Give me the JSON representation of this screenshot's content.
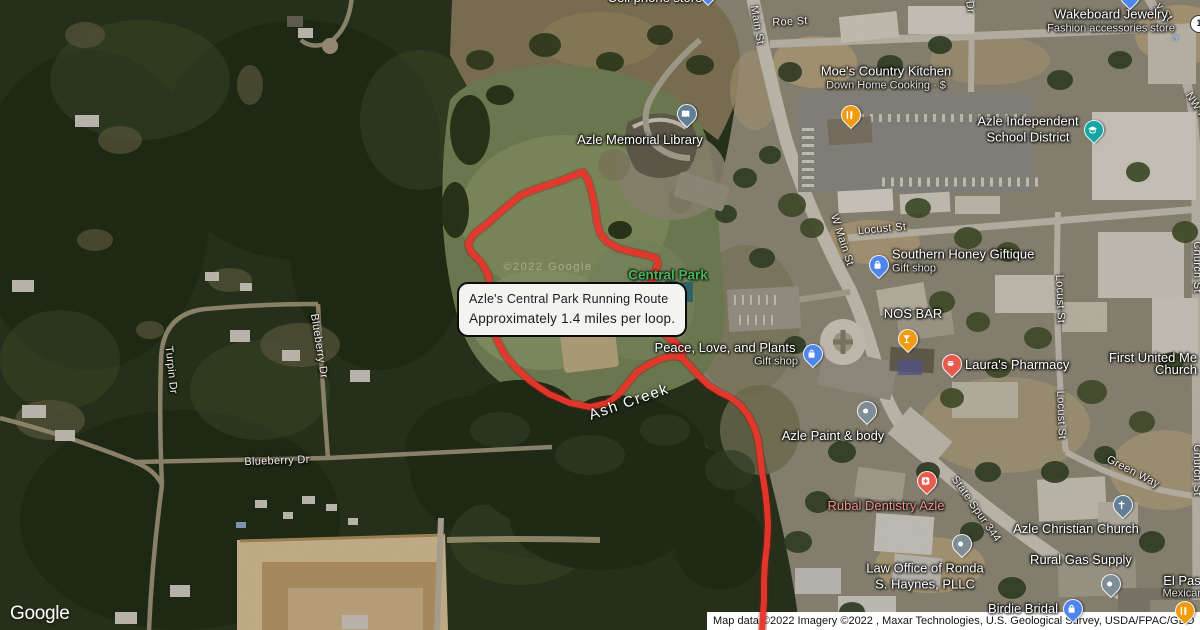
{
  "map": {
    "logo": "Google",
    "attribution": "Map data ©2022 Imagery ©2022 , Maxar Technologies, U.S. Geological Survey, USDA/FPAC/GEO",
    "tile_watermark": "©2022 Google",
    "shield_label": "1",
    "icons": {
      "airplane": "✈"
    },
    "info_box": {
      "title": "Azle's Central Park Running Route",
      "subtitle": "Approximately 1.4 miles per loop."
    },
    "colors": {
      "route": "#e8362c",
      "route_halo": "#8f1d14",
      "park_label": "#47b45b",
      "health_label": "#f0968c",
      "pin_blue": "#4f86ec",
      "pin_teal": "#15a6a4",
      "pin_orange": "#f09b10",
      "pin_red": "#e85a4e",
      "pin_gray": "#7f8d95",
      "pin_slate": "#627d96"
    },
    "route": {
      "loop": "M583,172 L560,181 L536,189 L521,195 L505,208 L487,224 L474,234 L468,244 L471,252 L481,262 L488,274 L490,288 L488,305 L490,320 L497,340 L505,355 L515,367 L530,381 L549,394 L570,403 L590,407 L607,403 L618,395 L628,383 L637,372 L648,365 L660,359 L672,356 L681,357 L683,351 L678,345 L668,337 L658,327 L652,315 L649,300 L650,286 L655,272 L658,264 L656,258 L646,255 L632,252 L618,248 L607,242 L600,233 L597,222 L595,207 L592,193 L588,180 Z",
      "tail": "M681,357 L690,366 L698,375 L708,385 L719,392 L731,398 L740,405 L748,415 L754,427 L758,440 L760,455 L762,472 L765,490 L767,508 L768,525 L767,545 L765,562 L764,580 L764,600 L763,615 L762,632"
    },
    "area_labels": [
      {
        "id": "central-park",
        "text": "Central Park",
        "x": 668,
        "y": 275,
        "cls": "park",
        "r": 0
      },
      {
        "id": "ash-creek",
        "text": "Ash Creek",
        "x": 629,
        "y": 402,
        "cls": "water",
        "r": -19
      }
    ],
    "street_labels": [
      {
        "text": "Roe St",
        "x": 790,
        "y": 22,
        "r": -3
      },
      {
        "text": "Main St",
        "x": 757,
        "y": 25,
        "r": 80
      },
      {
        "text": "W Main St",
        "x": 842,
        "y": 240,
        "r": 72
      },
      {
        "text": "Locust St",
        "x": 882,
        "y": 229,
        "r": -5
      },
      {
        "text": "Locust St",
        "x": 1060,
        "y": 299,
        "r": 88
      },
      {
        "text": "Locust St",
        "x": 1061,
        "y": 415,
        "r": 88
      },
      {
        "text": "Church St",
        "x": 1197,
        "y": 267,
        "r": 90
      },
      {
        "text": "Church St",
        "x": 1197,
        "y": 470,
        "r": 90
      },
      {
        "text": "NW P",
        "x": 1196,
        "y": 106,
        "r": 58
      },
      {
        "text": "y St",
        "x": 1164,
        "y": 12,
        "r": 52
      },
      {
        "text": "Dr",
        "x": 970,
        "y": 7,
        "r": 82
      },
      {
        "text": "State Spur 344",
        "x": 976,
        "y": 509,
        "r": 55
      },
      {
        "text": "Green Way",
        "x": 1133,
        "y": 472,
        "r": 27
      },
      {
        "text": "Turpin Dr",
        "x": 171,
        "y": 370,
        "r": 84
      },
      {
        "text": "Blueberry Dr",
        "x": 319,
        "y": 346,
        "r": 81
      },
      {
        "text": "Blueberry Dr",
        "x": 277,
        "y": 461,
        "r": -2
      }
    ],
    "pois": [
      {
        "id": "cell-phone-store",
        "lines": [
          "Cell phone store"
        ],
        "x": 655,
        "y": -2,
        "pin": {
          "x": 707,
          "y": 5,
          "color": "pin_blue",
          "glyph": "dot"
        }
      },
      {
        "id": "wakeboard-jewelry",
        "lines": [
          "Wakeboard Jewelry"
        ],
        "sub": "Fashion accessories store",
        "x": 1111,
        "y": 21,
        "pin": {
          "x": 1129,
          "y": 9,
          "color": "pin_blue",
          "glyph": "bag"
        }
      },
      {
        "id": "moes-country-kitchen",
        "lines": [
          "Moe's Country Kitchen"
        ],
        "sub": "Down Home Cooking · $",
        "x": 886,
        "y": 78,
        "pin": {
          "x": 850,
          "y": 128,
          "color": "pin_orange",
          "glyph": "restaurant"
        }
      },
      {
        "id": "azle-memorial-library",
        "lines": [
          "Azle Memorial Library"
        ],
        "x": 640,
        "y": 140,
        "pin": {
          "x": 686,
          "y": 127,
          "color": "pin_slate",
          "glyph": "book"
        }
      },
      {
        "id": "azle-independent-school-district",
        "lines": [
          "Azle Independent",
          "School District"
        ],
        "x": 1028,
        "y": 129,
        "pin": {
          "x": 1093,
          "y": 143,
          "color": "pin_teal",
          "glyph": "school"
        }
      },
      {
        "id": "southern-honey-giftique",
        "align": "left",
        "lines": [
          "Southern Honey Giftique"
        ],
        "sub": "Gift shop",
        "x": 892,
        "y": 261,
        "pin": {
          "x": 878,
          "y": 278,
          "color": "pin_blue",
          "glyph": "bag"
        }
      },
      {
        "id": "nos-bar",
        "lines": [
          "NOS BAR"
        ],
        "x": 913,
        "y": 314,
        "pin": {
          "x": 907,
          "y": 352,
          "color": "pin_orange",
          "glyph": "cocktail"
        }
      },
      {
        "id": "lauras-pharmacy",
        "align": "left",
        "lines": [
          "Laura's Pharmacy"
        ],
        "x": 965,
        "y": 365,
        "pin": {
          "x": 951,
          "y": 377,
          "color": "pin_red",
          "glyph": "pharmacy"
        }
      },
      {
        "id": "first-united-methodist-line1",
        "lines": [
          "First United Me"
        ],
        "x": 1153,
        "y": 358
      },
      {
        "id": "first-united-methodist-line2",
        "lines": [
          "Church"
        ],
        "x": 1176,
        "y": 370
      },
      {
        "id": "peace-love-and-plants",
        "lines": [
          "Peace, Love, and Plants"
        ],
        "x": 725,
        "y": 348,
        "pin": {
          "x": 812,
          "y": 367,
          "color": "pin_blue",
          "glyph": "bag"
        }
      },
      {
        "id": "peace-love-and-plants-sub",
        "cls": "sub-only",
        "lines": [
          "Gift shop"
        ],
        "x": 776,
        "y": 362
      },
      {
        "id": "azle-paint-and-body",
        "lines": [
          "Azle Paint & body"
        ],
        "x": 833,
        "y": 436,
        "pin": {
          "x": 866,
          "y": 424,
          "color": "pin_gray",
          "glyph": "dot"
        }
      },
      {
        "id": "rubal-dentistry-azle",
        "lines": [
          "Rubal Dentistry Azle"
        ],
        "color": "health_label",
        "x": 886,
        "y": 506,
        "pin": {
          "x": 926,
          "y": 494,
          "color": "pin_red",
          "glyph": "dentist"
        }
      },
      {
        "id": "azle-christian-church",
        "lines": [
          "Azle Christian Church"
        ],
        "x": 1076,
        "y": 529,
        "pin": {
          "x": 1122,
          "y": 518,
          "color": "pin_slate",
          "glyph": "church"
        }
      },
      {
        "id": "rural-gas-supply",
        "lines": [
          "Rural Gas Supply"
        ],
        "x": 1081,
        "y": 560,
        "pin": {
          "x": 1110,
          "y": 597,
          "color": "pin_gray",
          "glyph": "dot"
        }
      },
      {
        "id": "law-office-ronda-haynes",
        "lines": [
          "Law Office of Ronda",
          "S. Haynes, PLLC"
        ],
        "x": 925,
        "y": 576,
        "pin": {
          "x": 961,
          "y": 557,
          "color": "pin_gray",
          "glyph": "dot"
        }
      },
      {
        "id": "birdie-bridal",
        "lines": [
          "Birdie Bridal"
        ],
        "x": 1023,
        "y": 609,
        "pin": {
          "x": 1072,
          "y": 622,
          "color": "pin_blue",
          "glyph": "bag"
        }
      },
      {
        "id": "el-paso-line1",
        "lines": [
          "El Pas"
        ],
        "x": 1182,
        "y": 581,
        "pin": {
          "x": 1184,
          "y": 624,
          "color": "pin_orange",
          "glyph": "restaurant"
        }
      },
      {
        "id": "el-paso-line2",
        "cls": "sub-only",
        "lines": [
          "Mexican"
        ],
        "x": 1183,
        "y": 594
      }
    ]
  }
}
